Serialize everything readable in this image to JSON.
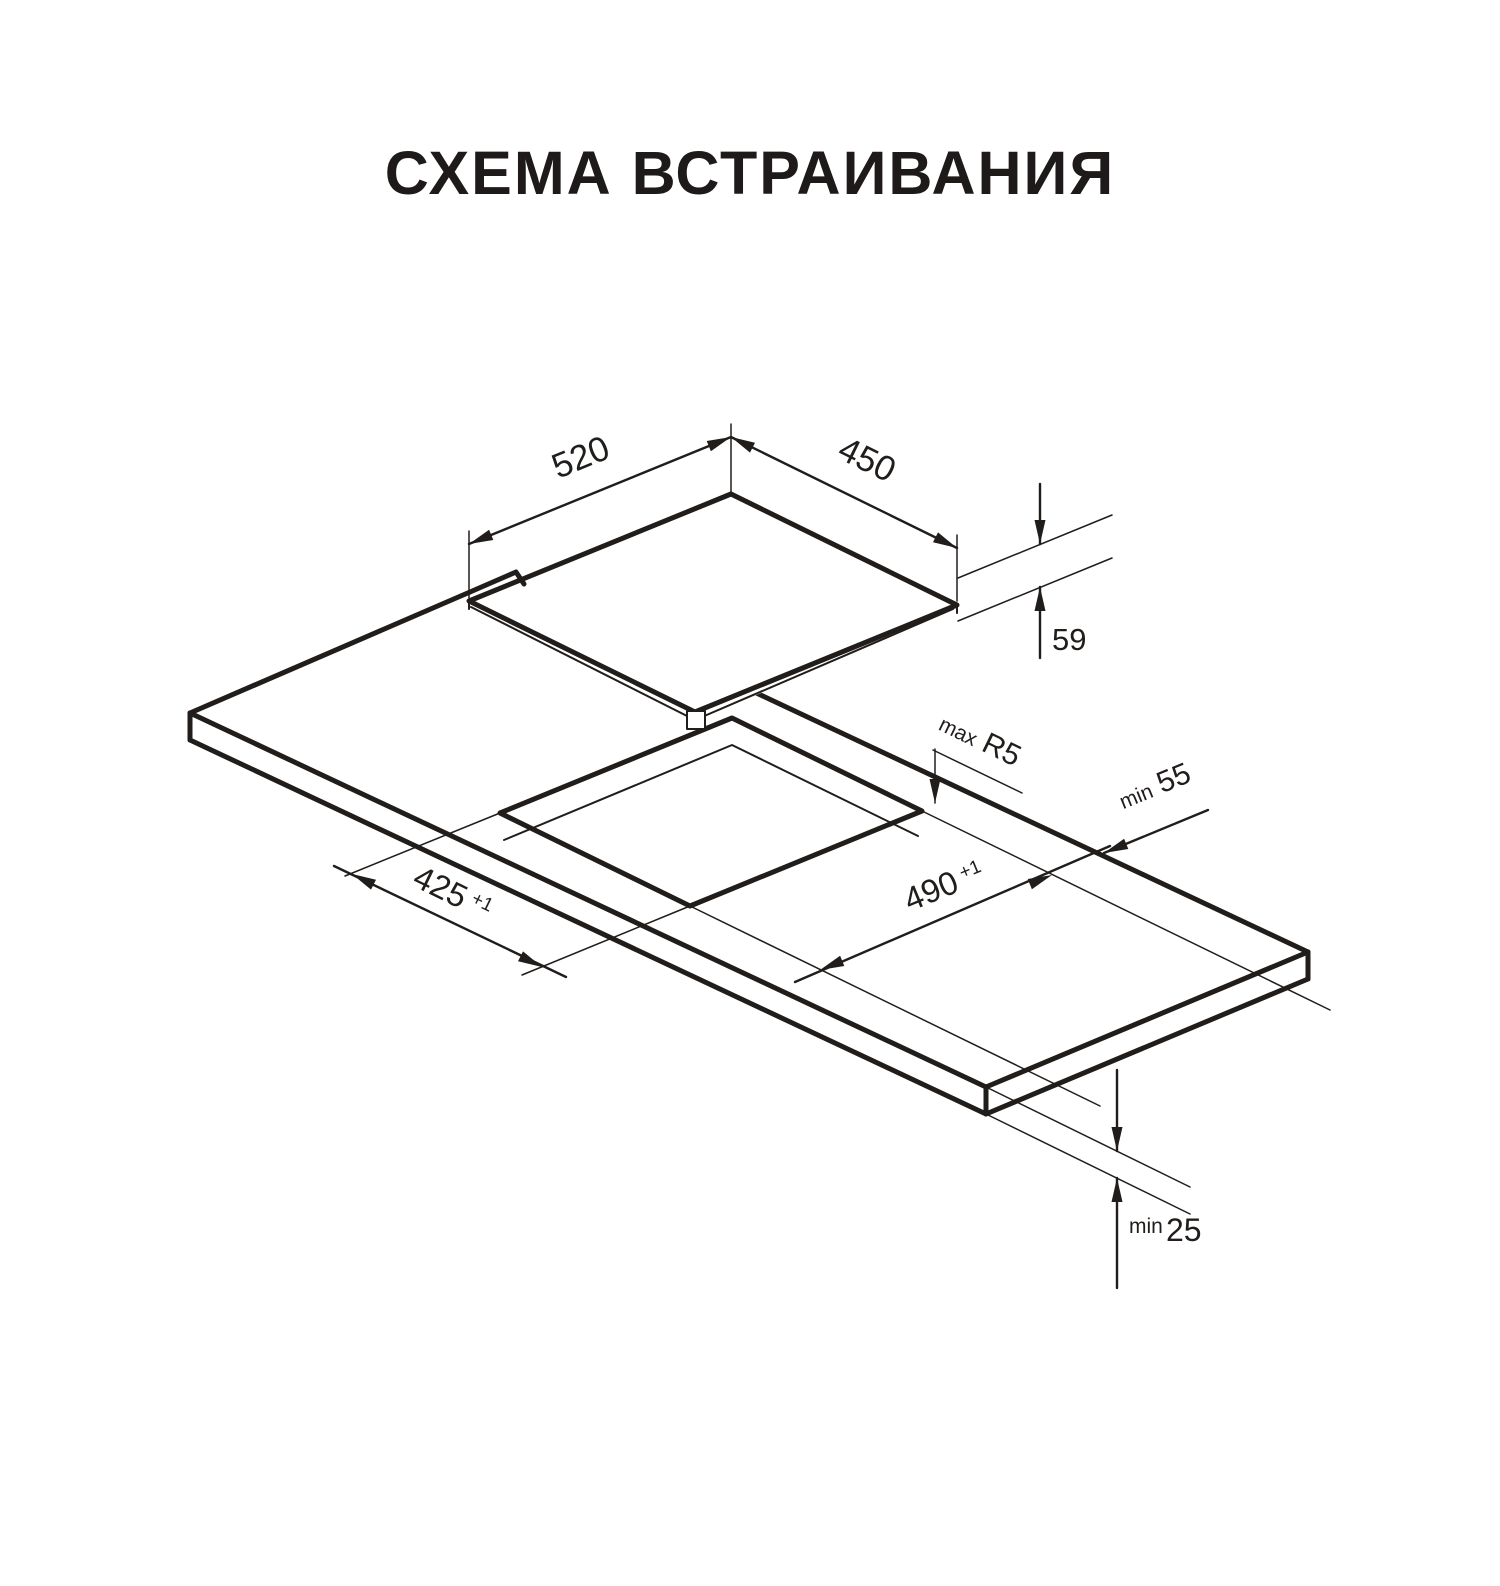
{
  "title": "СХЕМА ВСТРАИВАНИЯ",
  "colors": {
    "ink": "#201d1b",
    "background": "#ffffff"
  },
  "diagram": {
    "type": "isometric installation drawing of built-in hob over countertop cutout",
    "dimensions": {
      "hob_width": {
        "value": "520"
      },
      "hob_depth": {
        "value": "450"
      },
      "hob_height": {
        "value": "59"
      },
      "corner_radius": {
        "prefix": "max",
        "value": "R5"
      },
      "rear_clearance": {
        "prefix": "min",
        "value": "55"
      },
      "cutout_length": {
        "value": "490",
        "tolerance": "+1"
      },
      "cutout_width": {
        "value": "425",
        "tolerance": "+1"
      },
      "bottom_clearance": {
        "prefix": "min",
        "value": "25"
      }
    }
  }
}
